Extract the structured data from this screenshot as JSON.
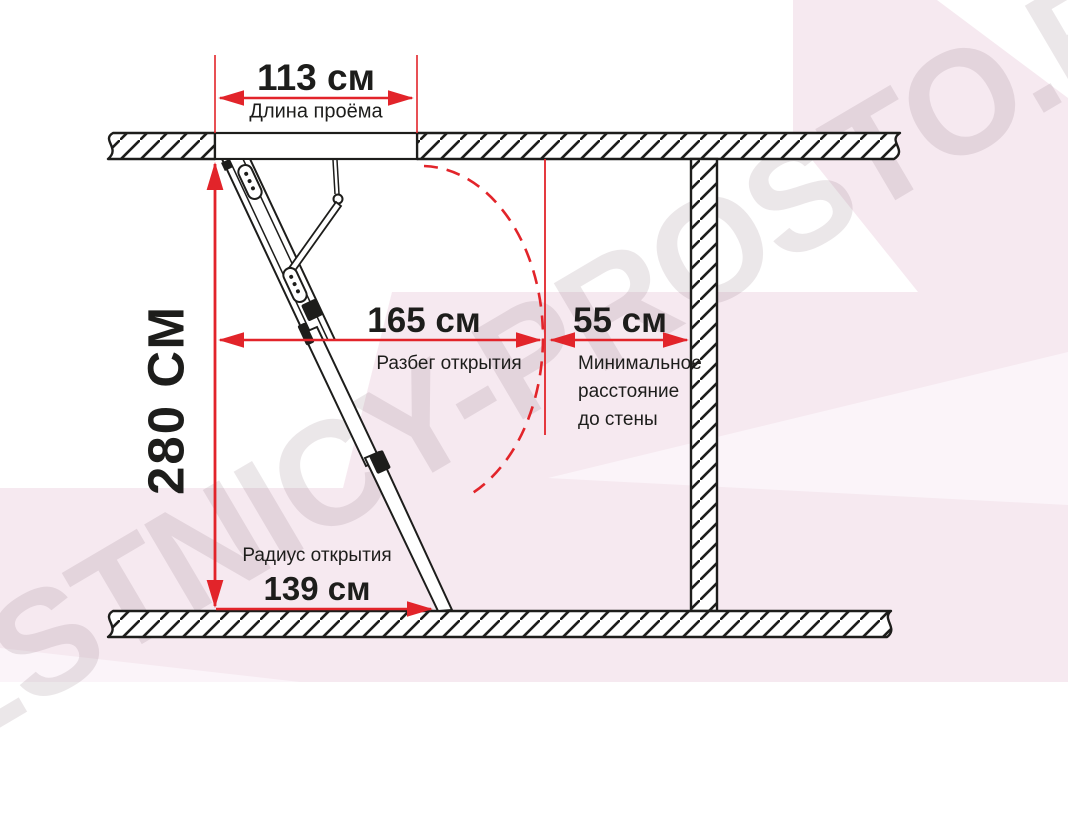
{
  "watermark": {
    "text": "LESTNICY-PROSTO.RU"
  },
  "labels": {
    "opening": {
      "value": "113 см",
      "caption": "Длина проёма"
    },
    "ceiling_height": {
      "value": "280 СМ"
    },
    "opening_run": {
      "value": "165 см",
      "caption": "Разбег открытия"
    },
    "wall_distance": {
      "value": "55 см",
      "caption_lines": [
        "Минимальное",
        "расстояние",
        "до стены"
      ]
    },
    "opening_radius": {
      "value": "139 см",
      "caption": "Радиус открытия"
    }
  },
  "colors": {
    "dimension_red": "#e2242a",
    "line_black": "#1d1d1b",
    "background_pink": "#f6e9f0",
    "background_pink_light": "#fbf4f9",
    "watermark_gray": "rgba(110,85,100,0.14)"
  }
}
